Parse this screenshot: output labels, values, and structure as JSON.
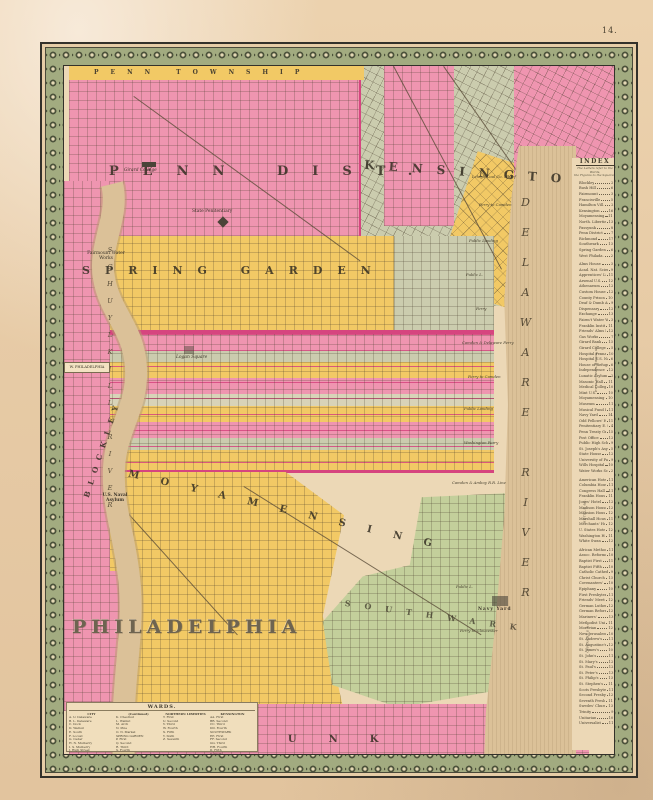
{
  "page": {
    "number": "14."
  },
  "palette": {
    "paper": "#e7cba6",
    "map_cream": "#ecd8b6",
    "pink": "#ef95b0",
    "magenta": "#d6457f",
    "yellow": "#f2c965",
    "olive_gray": "#cbccae",
    "green": "#c3cf9b",
    "river_tan": "#dbc198",
    "border_olive": "#a2ab80",
    "frame_dark": "#33312a",
    "ink": "#3e382b"
  },
  "map": {
    "districts": {
      "penn_township": "PENN TOWNSHIP",
      "penn_district": "PENN DIST.",
      "kensington": "KENSINGTON",
      "spring_garden": "SPRING GARDEN",
      "moyamensing": "MOYAMENSING",
      "southwark": "SOUTHWARK",
      "passyunk": "PASSYUNK",
      "blockley": "BLOCKLEY",
      "west_philadelphia": "W. PHILADELPHIA"
    },
    "rivers": {
      "schuylkill": "SCHUYLKILL RIVER",
      "delaware": "DELAWARE RIVER"
    },
    "landmarks": [
      "Girard College",
      "State Penitentiary",
      "Fairmount Water Works",
      "Logan Square",
      "U.S. Naval Asylum",
      "Navy Yard"
    ],
    "shore": [
      "Lehigh Coal Co. Wharf",
      "Ferry to Camden",
      "Public Landing",
      "Public L.",
      "Ferry",
      "Camden & Delaware Ferry",
      "Ferry to Camden",
      "Public Landing",
      "Washington Ferry",
      "Camden & Amboy R.R. Line",
      "Public L.",
      "Ferry to Gloucester"
    ],
    "index": {
      "title": "INDEX",
      "note1": "The Letters refer to the Wards,",
      "note2": "the Figures to the Squares.",
      "sections": [
        {
          "label": "DISTRICTS",
          "rows": [
            {
              "n": "Blockley",
              "r": "2 E"
            },
            {
              "n": "Bush Hill",
              "r": "6 C"
            },
            {
              "n": "Fairmount",
              "r": "3 B"
            },
            {
              "n": "Francisville",
              "r": "5 B"
            },
            {
              "n": "Hamilton Vill.",
              "r": "2 F"
            },
            {
              "n": "Kensington",
              "r": "16 B"
            },
            {
              "n": "Moyamensing",
              "r": "11 H"
            },
            {
              "n": "North. Liberties",
              "r": "13 C"
            },
            {
              "n": "Passyunk",
              "r": "8 K"
            },
            {
              "n": "Penn District",
              "r": "7 A"
            },
            {
              "n": "Richmond",
              "r": "17 A"
            },
            {
              "n": "Southwark",
              "r": "13 G"
            },
            {
              "n": "Spring Garden",
              "r": "6 C"
            },
            {
              "n": "West Philada.",
              "r": "2 D"
            }
          ]
        },
        {
          "label": "PUBLIC BUILDINGS &c.",
          "rows": [
            {
              "n": "Alms House",
              "r": "3 G"
            },
            {
              "n": "Acad. Nat. Sciences",
              "r": "9 D"
            },
            {
              "n": "Apprentices' Libr.",
              "r": "11 C"
            },
            {
              "n": "Arsenal U.S.",
              "r": "12 G"
            },
            {
              "n": "Athenaeum",
              "r": "12 E"
            },
            {
              "n": "Custom House",
              "r": "12 E"
            },
            {
              "n": "County Prison",
              "r": "10 H"
            },
            {
              "n": "Deaf & Dumb Asyl.",
              "r": "9 E"
            },
            {
              "n": "Dispensary",
              "r": "12 E"
            },
            {
              "n": "Exchange",
              "r": "13 E"
            },
            {
              "n": "Fairm't Water Wks.",
              "r": "3 B"
            },
            {
              "n": "Franklin Institute",
              "r": "11 D"
            },
            {
              "n": "Friends' Alms Ho.",
              "r": "12 E"
            },
            {
              "n": "Gas Works",
              "r": "7 F"
            },
            {
              "n": "Girard Bank",
              "r": "13 D"
            },
            {
              "n": "Girard College",
              "r": "5 A"
            },
            {
              "n": "Hospital Penna.",
              "r": "10 F"
            },
            {
              "n": "Hospital U.S. Naval",
              "r": "6 G"
            },
            {
              "n": "House of Refuge",
              "r": "6 B"
            },
            {
              "n": "Independence Hall",
              "r": "12 E"
            },
            {
              "n": "Lunatic Asylum",
              "r": "2 E"
            },
            {
              "n": "Masonic Hall",
              "r": "11 D"
            },
            {
              "n": "Medical College",
              "r": "10 E"
            },
            {
              "n": "Mint U.S.",
              "r": "10 D"
            },
            {
              "n": "Moyamensing Pris.",
              "r": "10 H"
            },
            {
              "n": "Museum",
              "r": "11 E"
            },
            {
              "n": "Musical Fund Hall",
              "r": "11 E"
            },
            {
              "n": "Navy Yard",
              "r": "14 H"
            },
            {
              "n": "Odd Fellows' Hall",
              "r": "11 C"
            },
            {
              "n": "Penitentiary E. State",
              "r": "4 B"
            },
            {
              "n": "Penn Treaty Gr'd",
              "r": "15 B"
            },
            {
              "n": "Post Office",
              "r": "12 E"
            },
            {
              "n": "Public High School",
              "r": "9 C"
            },
            {
              "n": "St. Joseph's Asyl.",
              "r": "5 B"
            },
            {
              "n": "State House",
              "r": "12 E"
            },
            {
              "n": "University of Pa.",
              "r": "9 E"
            },
            {
              "n": "Wills Hospital",
              "r": "10 D"
            },
            {
              "n": "Water Works Schl.",
              "r": "2 B"
            }
          ]
        },
        {
          "label": "HOTELS &c.",
          "rows": [
            {
              "n": "American Hotel",
              "r": "11 E"
            },
            {
              "n": "Columbia House",
              "r": "11 E"
            },
            {
              "n": "Congress Hall",
              "r": "11 E"
            },
            {
              "n": "Franklin House",
              "r": "11 D"
            },
            {
              "n": "Jones' Hotel",
              "r": "12 E"
            },
            {
              "n": "Madison House",
              "r": "12 C"
            },
            {
              "n": "Mansion House",
              "r": "12 D"
            },
            {
              "n": "Marshall House",
              "r": "11 C"
            },
            {
              "n": "Merchants' Hotel",
              "r": "12 D"
            },
            {
              "n": "U. States Hotel",
              "r": "12 D"
            },
            {
              "n": "Washington House",
              "r": "11 D"
            },
            {
              "n": "White Swan",
              "r": "12 C"
            }
          ]
        },
        {
          "label": "CHURCHES &c.",
          "rows": [
            {
              "n": "African Methodist",
              "r": "11 F"
            },
            {
              "n": "Assoc. Reformed",
              "r": "10 E"
            },
            {
              "n": "Baptist First",
              "r": "11 C"
            },
            {
              "n": "Baptist Fifth",
              "r": "10 C"
            },
            {
              "n": "Catholic Cathedral",
              "r": "9 D"
            },
            {
              "n": "Christ Church",
              "r": "13 D"
            },
            {
              "n": "Covenanters'",
              "r": "10 C"
            },
            {
              "n": "Epiphany",
              "r": "10 D"
            },
            {
              "n": "First Presbyterian",
              "r": "11 E"
            },
            {
              "n": "Friends' Meeting",
              "r": "12 D"
            },
            {
              "n": "German Lutheran",
              "r": "12 C"
            },
            {
              "n": "German Reformed",
              "r": "12 C"
            },
            {
              "n": "Mariners'",
              "r": "13 F"
            },
            {
              "n": "Methodist Union",
              "r": "11 D"
            },
            {
              "n": "Moravian",
              "r": "12 D"
            },
            {
              "n": "New Jerusalem",
              "r": "10 E"
            },
            {
              "n": "St. Andrew's",
              "r": "11 E"
            },
            {
              "n": "St. Augustine's",
              "r": "12 C"
            },
            {
              "n": "St. James's",
              "r": "10 D"
            },
            {
              "n": "St. John's",
              "r": "11 E"
            },
            {
              "n": "St. Mary's",
              "r": "12 E"
            },
            {
              "n": "St. Paul's",
              "r": "12 F"
            },
            {
              "n": "St. Peter's",
              "r": "13 F"
            },
            {
              "n": "St. Philip's",
              "r": "13 G"
            },
            {
              "n": "St. Stephen's",
              "r": "11 D"
            },
            {
              "n": "Scots Presbyterian",
              "r": "11 F"
            },
            {
              "n": "Second Presbyt.",
              "r": "12 C"
            },
            {
              "n": "Seventh Presbyt.",
              "r": "11 D"
            },
            {
              "n": "Swedes' Church",
              "r": "13 G"
            },
            {
              "n": "Trinity",
              "r": "9 F"
            },
            {
              "n": "Unitarian",
              "r": "10 E"
            },
            {
              "n": "Universalist",
              "r": "11 F"
            }
          ]
        }
      ]
    },
    "legend": {
      "title": "PHILADELPHIA",
      "wards_title": "WARDS.",
      "col1": {
        "header": "CITY",
        "rows": [
          "A. U. Delaware",
          "B. L. Delaware",
          "C. Dock",
          "D. Walnut",
          "E. South",
          "F. Locust",
          "G. Cedar",
          "H. N. Mulberry",
          "I. S. Mulberry",
          "J. High Street"
        ]
      },
      "col2": {
        "header": "(Continued)",
        "rows": [
          "K. Chestnut",
          "L. Walnut",
          "M. Arch",
          "N. Pine",
          "O. N. Market",
          "SPRING GARDEN",
          "P. First",
          "Q. Second",
          "R. Third",
          "S. Fourth"
        ]
      },
      "col3": {
        "header": "NORTHERN LIBERTIES",
        "rows": [
          "T. First",
          "U. Second",
          "V. Third",
          "W. Fourth",
          "X. Fifth",
          "Y. Sixth",
          "Z. Seventh"
        ]
      },
      "col4": {
        "header": "KENSINGTON",
        "rows": [
          "AA. First",
          "BB. Second",
          "CC. Third",
          "DD. Fourth",
          "SOUTHWARK",
          "EE. First",
          "FF. Second",
          "GG. Third",
          "HH. Fourth",
          "II. Fifth",
          "JJ. Sixth"
        ]
      },
      "scale": {
        "caption": "Scale of Feet.",
        "ticks": [
          "500",
          "0",
          "500",
          "1000",
          "1500",
          "2000"
        ]
      }
    }
  }
}
